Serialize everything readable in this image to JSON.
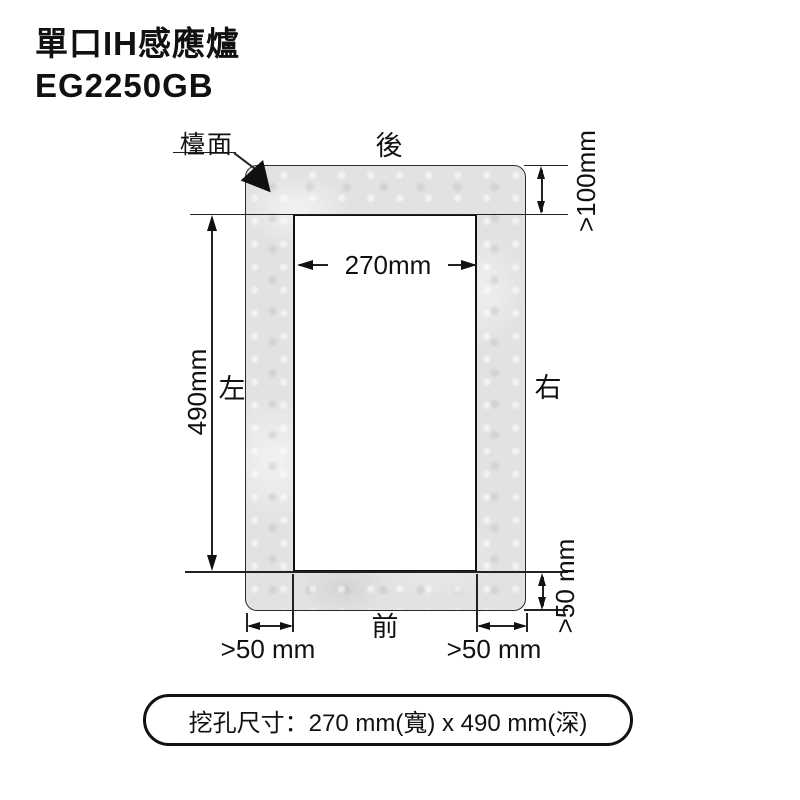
{
  "header": {
    "title": "單口IH感應爐",
    "model": "EG2250GB"
  },
  "diagram": {
    "labels": {
      "countertop": "檯面",
      "rear": "後",
      "front": "前",
      "left": "左",
      "right": "右"
    },
    "dims": {
      "cutout_width": "270mm",
      "cutout_depth": "490mm",
      "rear_clearance": ">100mm",
      "front_clearance": ">50 mm",
      "left_clearance": ">50 mm",
      "right_clearance": ">50 mm"
    },
    "colors": {
      "line": "#222222",
      "counter_fill": "#e2e2e2",
      "background": "#ffffff"
    }
  },
  "caption": "挖孔尺寸：270 mm(寬) x 490 mm(深)"
}
